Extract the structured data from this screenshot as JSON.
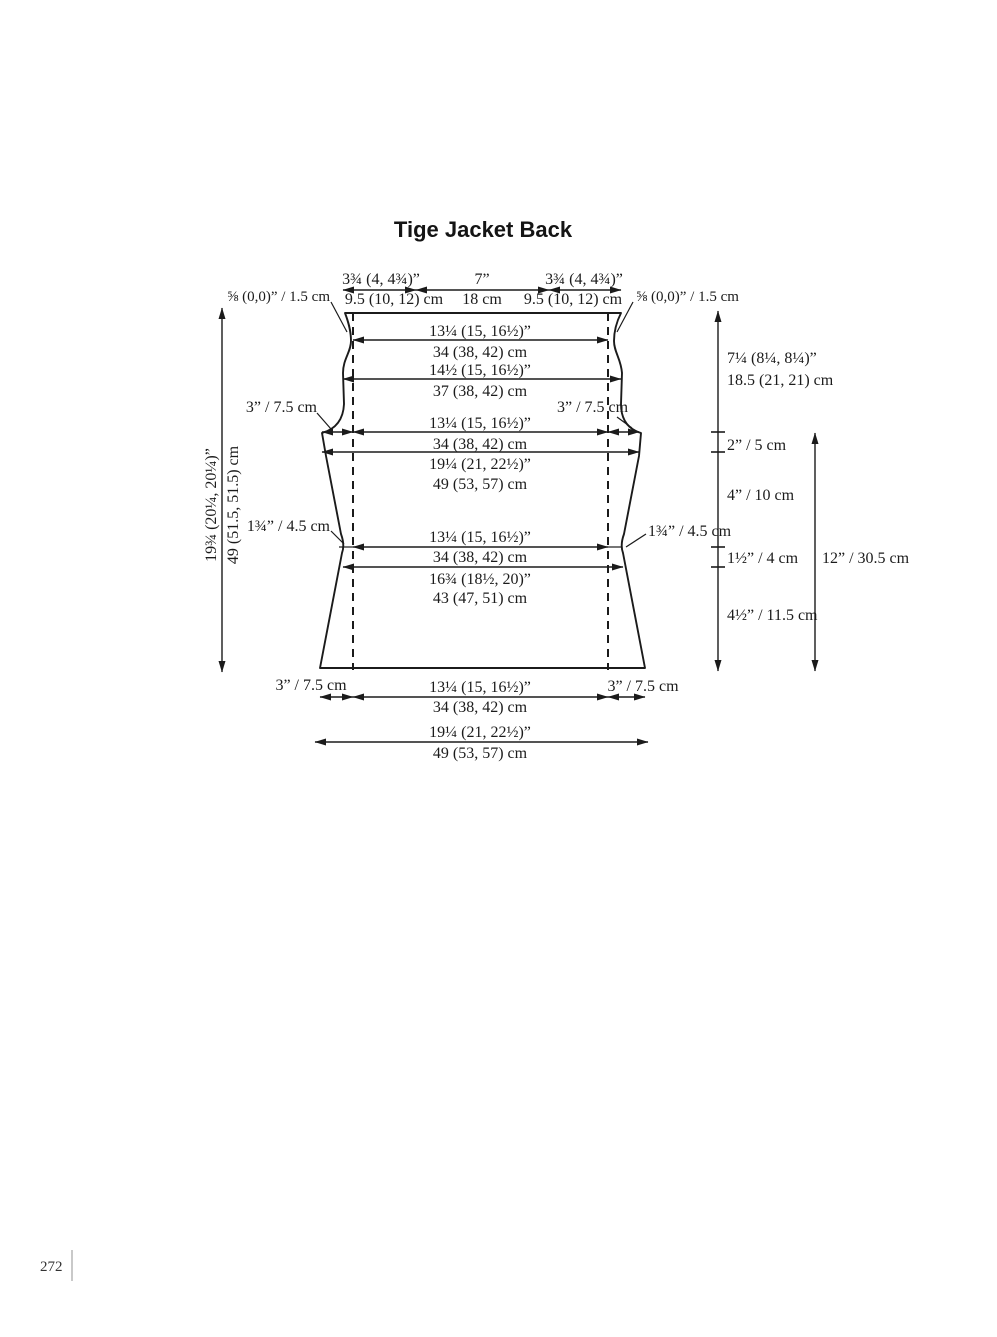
{
  "title": "Tige Jacket Back",
  "page_number": "272",
  "top": {
    "seam_left": "⅝ (0,0)” / 1.5 cm",
    "shoulder_left_in": "3¾ (4, 4¾)”",
    "shoulder_left_cm": "9.5 (10, 12) cm",
    "neck_in": "7”",
    "neck_cm": "18 cm",
    "shoulder_right_in": "3¾ (4, 4¾)”",
    "shoulder_right_cm": "9.5 (10, 12) cm",
    "seam_right": "⅝ (0,0)” / 1.5 cm"
  },
  "widths": {
    "neck_in": "13¼ (15, 16½)”",
    "neck_cm": "34 (38, 42) cm",
    "upper_in": "14½ (15, 16½)”",
    "upper_cm": "37 (38, 42) cm",
    "armhole_notch_left": "3” / 7.5 cm",
    "armhole_notch_right": "3” / 7.5 cm",
    "cross_in": "13¼ (15, 16½)”",
    "cross_cm": "34 (38, 42) cm",
    "chest_in": "19¼ (21, 22½)”",
    "chest_cm": "49 (53, 57) cm",
    "waist_notch_left": "1¾” / 4.5 cm",
    "waist_notch_right": "1¾” / 4.5 cm",
    "waist_inner_in": "13¼ (15, 16½)”",
    "waist_inner_cm": "34 (38, 42) cm",
    "waist_full_in": "16¾ (18½, 20)”",
    "waist_full_cm": "43 (47, 51) cm",
    "hem_notch_left": "3” / 7.5 cm",
    "hem_notch_right": "3” / 7.5 cm",
    "hem_inner_in": "13¼ (15, 16½)”",
    "hem_inner_cm": "34 (38, 42) cm",
    "hem_full_in": "19¼ (21, 22½)”",
    "hem_full_cm": "49 (53, 57) cm"
  },
  "heights": {
    "total_in": "19¾ (20¼, 20¼)”",
    "total_cm": "49 (51.5, 51.5) cm",
    "yoke_in": "7¼ (8¼, 8¼)”",
    "yoke_cm": "18.5 (21, 21) cm",
    "armhole_band": "2” / 5 cm",
    "chest_to_waist": "4” / 10 cm",
    "waist_band": "1½” / 4 cm",
    "waist_to_hem": "4½” / 11.5 cm",
    "body_length": "12” / 30.5 cm"
  }
}
